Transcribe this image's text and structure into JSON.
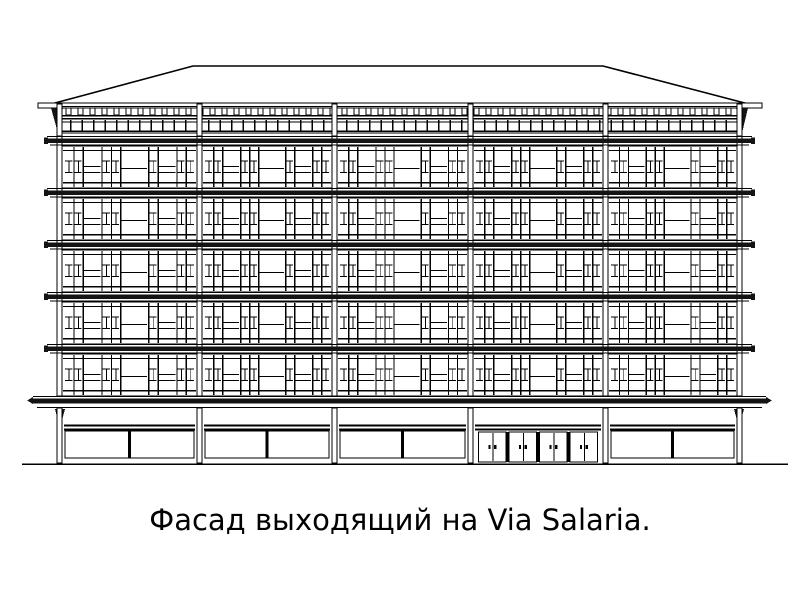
{
  "page": {
    "background": "#ffffff",
    "ink": "#000000",
    "dark_fill": "#141414"
  },
  "caption": {
    "text": "Фасад выходящий на Via Salaria.",
    "font_size_px": 29,
    "color": "#000000"
  },
  "drawing": {
    "type": "architectural-elevation",
    "subject": "building-facade-line-drawing",
    "floors_above_ground": 5,
    "bays": 5,
    "entrance_door_pairs": 4,
    "geometry": {
      "pier_xs": [
        57,
        197,
        332,
        468,
        603,
        737
      ],
      "pier_w": 5,
      "roof": {
        "ridge_y": 66,
        "ridge_x1": 193,
        "ridge_x2": 603,
        "eave_y": 107,
        "eave_x1": 40,
        "eave_x2": 760,
        "fascia_y": 103,
        "fascia_h": 5
      },
      "parapet": {
        "rail_y": 106,
        "post_y": 108,
        "post_h": 7,
        "post_w": 5,
        "post_step": 12,
        "mid_y": 115,
        "band_top": 119,
        "band_bot": 133,
        "mull_step": 11.5
      },
      "cornice": {
        "tops": [
          136,
          188,
          240,
          292,
          344
        ],
        "h": 10,
        "x1": 47,
        "x2": 752
      },
      "floor": {
        "window_tops": [
          146,
          198,
          250,
          302,
          354
        ],
        "h": 42,
        "pattern": [
          1,
          1,
          2,
          1,
          1,
          3,
          1,
          2,
          1,
          1
        ],
        "narrow_t1": 0.34,
        "narrow_t2": 0.62,
        "mid_t": 0.48,
        "wide_t": 0.52,
        "sill": 0.86
      },
      "canopy": {
        "top": 396,
        "x1": 33,
        "x2": 766,
        "bot": 407
      },
      "ground": {
        "top": 408,
        "bot": 462,
        "transom_y": 424.5,
        "transom_y2": 428.5,
        "shop_top": 431,
        "shop_bot": 458,
        "door_top": 432,
        "door_bot": 462,
        "entrance_bay": 3
      },
      "ground_line": {
        "y": 463.5,
        "x1": 22,
        "x2": 788,
        "t": 1.6
      }
    }
  }
}
